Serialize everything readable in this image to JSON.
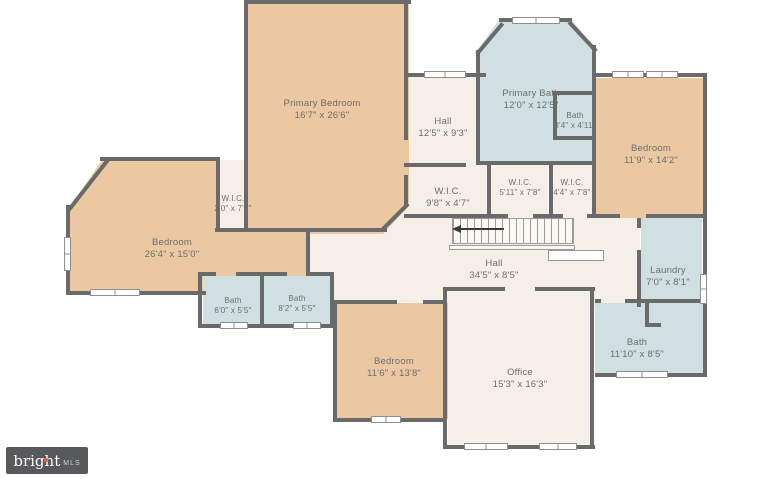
{
  "page": {
    "type": "floor-plan",
    "background": "#ffffff"
  },
  "palette": {
    "wall": "#6a6a6a",
    "bedroom_fill": "#ebc8a1",
    "bath_fill": "#cfdfe2",
    "hall_fill": "#f6efe8",
    "label_text": "#6e6e6e"
  },
  "branding": {
    "logo_primary": "bright",
    "logo_secondary": "MLS",
    "logo_background": "#58595b",
    "logo_dot_color": "#e8622b"
  },
  "rooms": [
    {
      "id": "primary-bedroom",
      "name": "Primary Bedroom",
      "dimensions": "16'7\" x 26'6\"",
      "category": "bedroom"
    },
    {
      "id": "primary-bath",
      "name": "Primary Bath",
      "dimensions": "12'0\" x 12'5\"",
      "category": "bath"
    },
    {
      "id": "bath-upper",
      "name": "Bath",
      "dimensions": "3'4\" x 4'11\"",
      "category": "bath"
    },
    {
      "id": "hall-upper",
      "name": "Hall",
      "dimensions": "12'5\" x 9'3\"",
      "category": "hall"
    },
    {
      "id": "bedroom-right",
      "name": "Bedroom",
      "dimensions": "11'9\" x 14'2\"",
      "category": "bedroom"
    },
    {
      "id": "wic-narrow",
      "name": "W.I.C.",
      "dimensions": "2'0\" x 7'2\"",
      "category": "closet"
    },
    {
      "id": "wic-center",
      "name": "W.I.C.",
      "dimensions": "9'8\" x 4'7\"",
      "category": "closet"
    },
    {
      "id": "wic-mid",
      "name": "W.I.C.",
      "dimensions": "5'11\" x 7'8\"",
      "category": "closet"
    },
    {
      "id": "wic-right",
      "name": "W.I.C.",
      "dimensions": "4'4\" x 7'8\"",
      "category": "closet"
    },
    {
      "id": "bedroom-left",
      "name": "Bedroom",
      "dimensions": "26'4\" x 15'0\"",
      "category": "bedroom"
    },
    {
      "id": "bath-left",
      "name": "Bath",
      "dimensions": "6'0\" x 5'5\"",
      "category": "bath"
    },
    {
      "id": "bath-mid",
      "name": "Bath",
      "dimensions": "8'2\" x 5'5\"",
      "category": "bath"
    },
    {
      "id": "hall-main",
      "name": "Hall",
      "dimensions": "34'5\" x 8'5\"",
      "category": "hall"
    },
    {
      "id": "laundry",
      "name": "Laundry",
      "dimensions": "7'0\" x 8'1\"",
      "category": "laundry"
    },
    {
      "id": "bath-right",
      "name": "Bath",
      "dimensions": "11'10\" x 8'5\"",
      "category": "bath"
    },
    {
      "id": "bedroom-bottom",
      "name": "Bedroom",
      "dimensions": "11'6\" x 13'8\"",
      "category": "bedroom"
    },
    {
      "id": "office",
      "name": "Office",
      "dimensions": "15'3\" x 16'3\"",
      "category": "office"
    }
  ]
}
